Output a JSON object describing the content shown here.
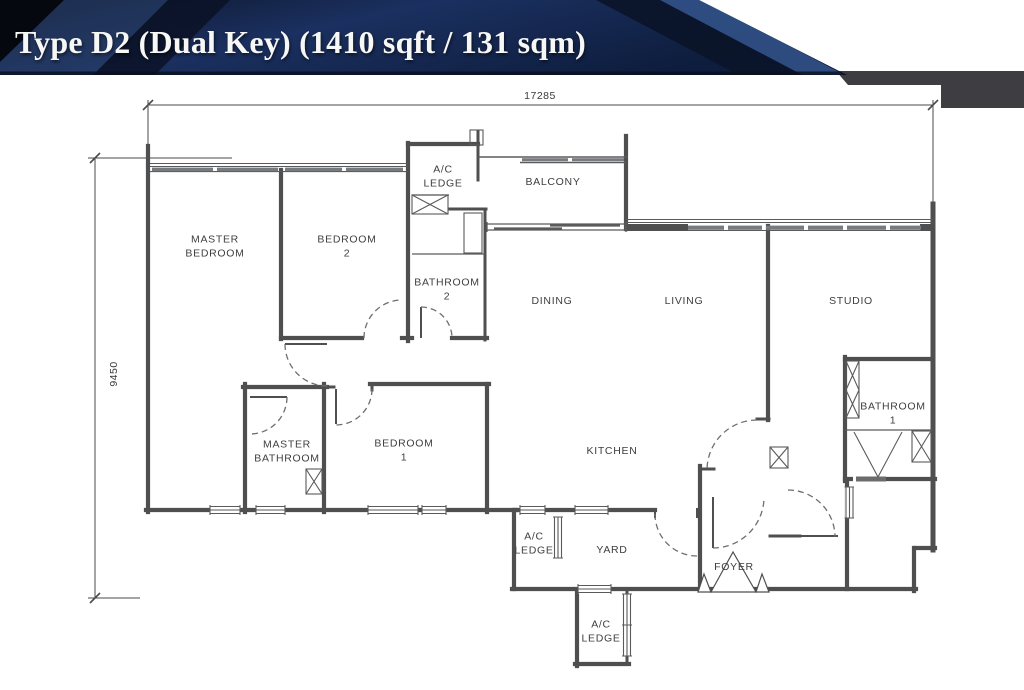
{
  "banner": {
    "title": "Type D2 (Dual Key) (1410 sqft / 131 sqm)"
  },
  "dimensions": {
    "width": "17285",
    "height": "9450"
  },
  "rooms": {
    "master_bedroom": "MASTER\nBEDROOM",
    "bedroom_2": "BEDROOM\n2",
    "ac_ledge_top": "A/C\nLEDGE",
    "balcony": "BALCONY",
    "bathroom_2": "BATHROOM\n2",
    "dining": "DINING",
    "living": "LIVING",
    "studio": "STUDIO",
    "master_bathroom": "MASTER\nBATHROOM",
    "bedroom_1": "BEDROOM\n1",
    "kitchen": "KITCHEN",
    "bathroom_1": "BATHROOM\n1",
    "ac_ledge_side": "A/C\nLEDGE",
    "yard": "YARD",
    "foyer": "FOYER",
    "ac_ledge_bottom": "A/C\nLEDGE"
  },
  "colors": {
    "banner_navy": "#111f3d",
    "banner_accent": "#33538a",
    "corner_gray": "#3d3d42",
    "plan_line": "#4f4f4f"
  }
}
